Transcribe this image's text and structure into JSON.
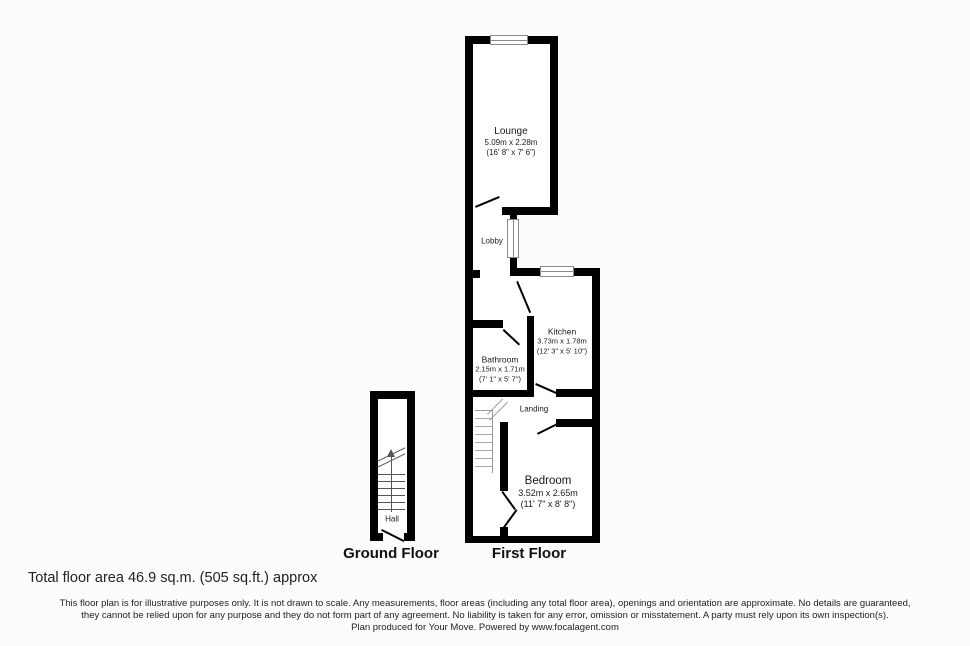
{
  "rooms": {
    "lounge": {
      "name": "Lounge",
      "dim_metric": "5.09m x 2.28m",
      "dim_imperial": "(16' 8\" x 7' 6\")"
    },
    "lobby": {
      "name": "Lobby"
    },
    "kitchen": {
      "name": "Kitchen",
      "dim_metric": "3.73m x 1.78m",
      "dim_imperial": "(12' 3\" x 5' 10\")"
    },
    "bathroom": {
      "name": "Bathroom",
      "dim_metric": "2.15m x 1.71m",
      "dim_imperial": "(7' 1\" x 5' 7\")"
    },
    "landing": {
      "name": "Landing"
    },
    "bedroom": {
      "name": "Bedroom",
      "dim_metric": "3.52m x 2.65m",
      "dim_imperial": "(11' 7\" x 8' 8\")"
    },
    "hall": {
      "name": "Hall"
    }
  },
  "floor_labels": {
    "ground": "Ground Floor",
    "first": "First Floor"
  },
  "summary": {
    "total_area": "Total floor area 46.9 sq.m. (505 sq.ft.) approx"
  },
  "disclaimer": {
    "line1": "This floor plan is for illustrative purposes only. It is not drawn to scale. Any measurements, floor areas (including any total floor area), openings and orientation are approximate. No details are guaranteed,",
    "line2": "they cannot be relied upon for any purpose and they do not form part of any agreement. No liability is taken for any error, omission or misstatement. A party must rely upon its own inspection(s).",
    "line3": "Plan produced for Your Move. Powered by www.focalagent.com"
  },
  "colors": {
    "wall": "#000000",
    "background": "#fcfcfc",
    "room_fill": "#ffffff",
    "window_frame": "#8a8a8a",
    "stair_ground": "#555555",
    "stair_first": "#9a9a9a",
    "text": "#1a1a1a"
  }
}
